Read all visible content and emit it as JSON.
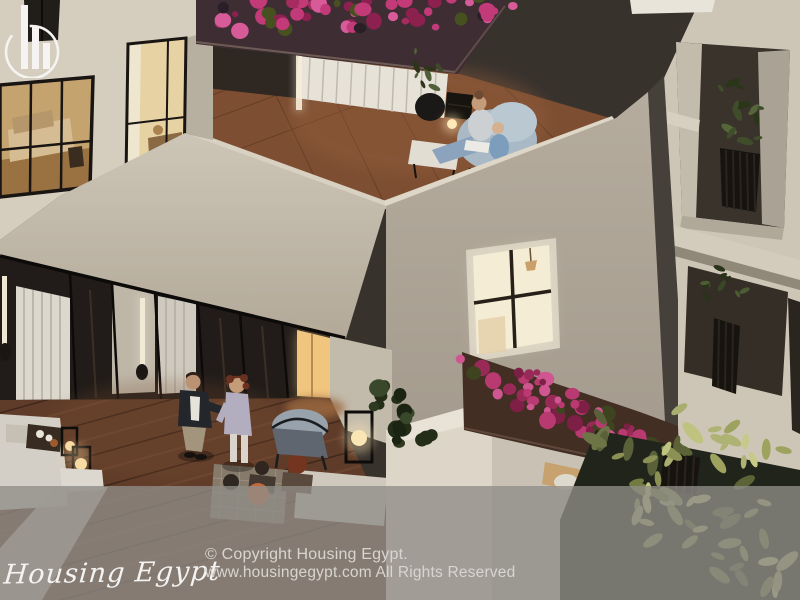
{
  "watermark": {
    "brand_name": "Housing Egypt",
    "copyright_line1": "© Copyright Housing Egypt.",
    "copyright_line2": "www.housingegypt.com All Rights Reserved",
    "logo_icon": "buildings-in-circle-icon"
  },
  "scene": {
    "colors": {
      "overlay_gray": "#908d88",
      "wall_cream": "#d5cdbe",
      "wall_mid": "#c6beaf",
      "wall_shaded": "#aba294",
      "wall_bright": "#ddd6c8",
      "facade_right": "#cdc5b6",
      "terracotta": "#7d4e32",
      "deck_wood": "#5f3c29",
      "glass_dark": "#211c19",
      "planter_brown": "#432e24",
      "planter_top_brown": "#3f2d34",
      "window_glow": "#f4ecd4",
      "lantern_glow": "#f9e6b4",
      "flowers_pink": "#c23a78",
      "foliage_dark": "#2e3a20",
      "leaves_pale": "#aeb272",
      "text_light": "#d8d5d0"
    }
  }
}
